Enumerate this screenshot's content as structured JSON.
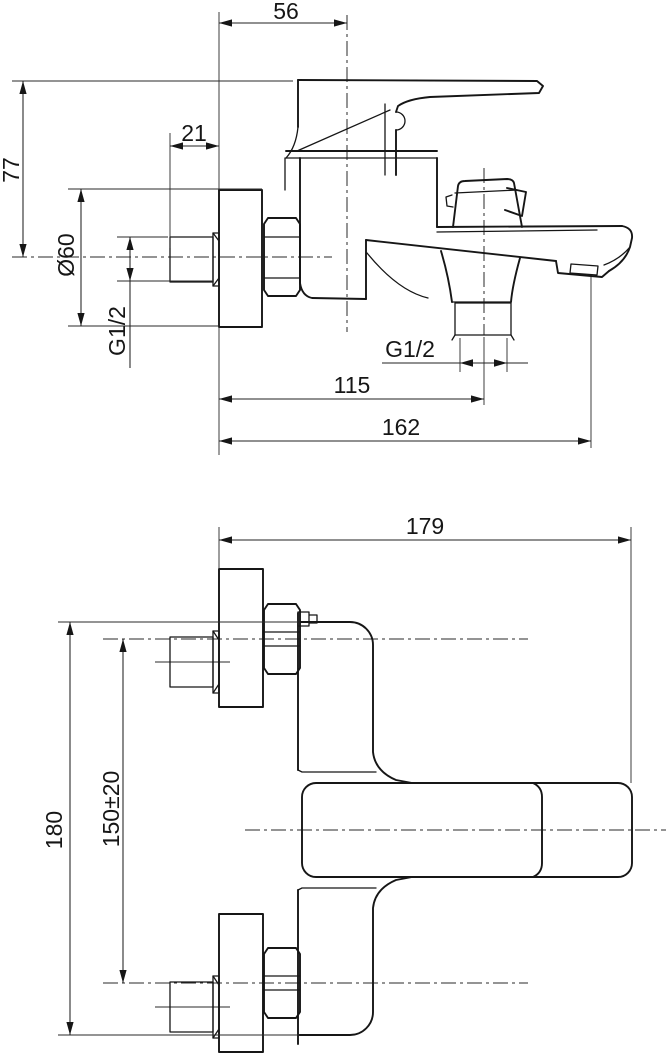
{
  "drawing": {
    "background": "#ffffff",
    "line_color": "#161616",
    "side_view": {
      "dims": {
        "handle_center_offset": "56",
        "inlet_thread_length": "21",
        "height_above_axis": "77",
        "flange_diameter": "Ø60",
        "inlet_thread_size": "G1/2",
        "outlet_thread_size": "G1/2",
        "outlet_center_reach": "115",
        "spout_reach": "162"
      }
    },
    "plan_view": {
      "dims": {
        "overall_depth": "179",
        "overall_width": "180",
        "inlet_spacing": "150±20"
      }
    }
  }
}
